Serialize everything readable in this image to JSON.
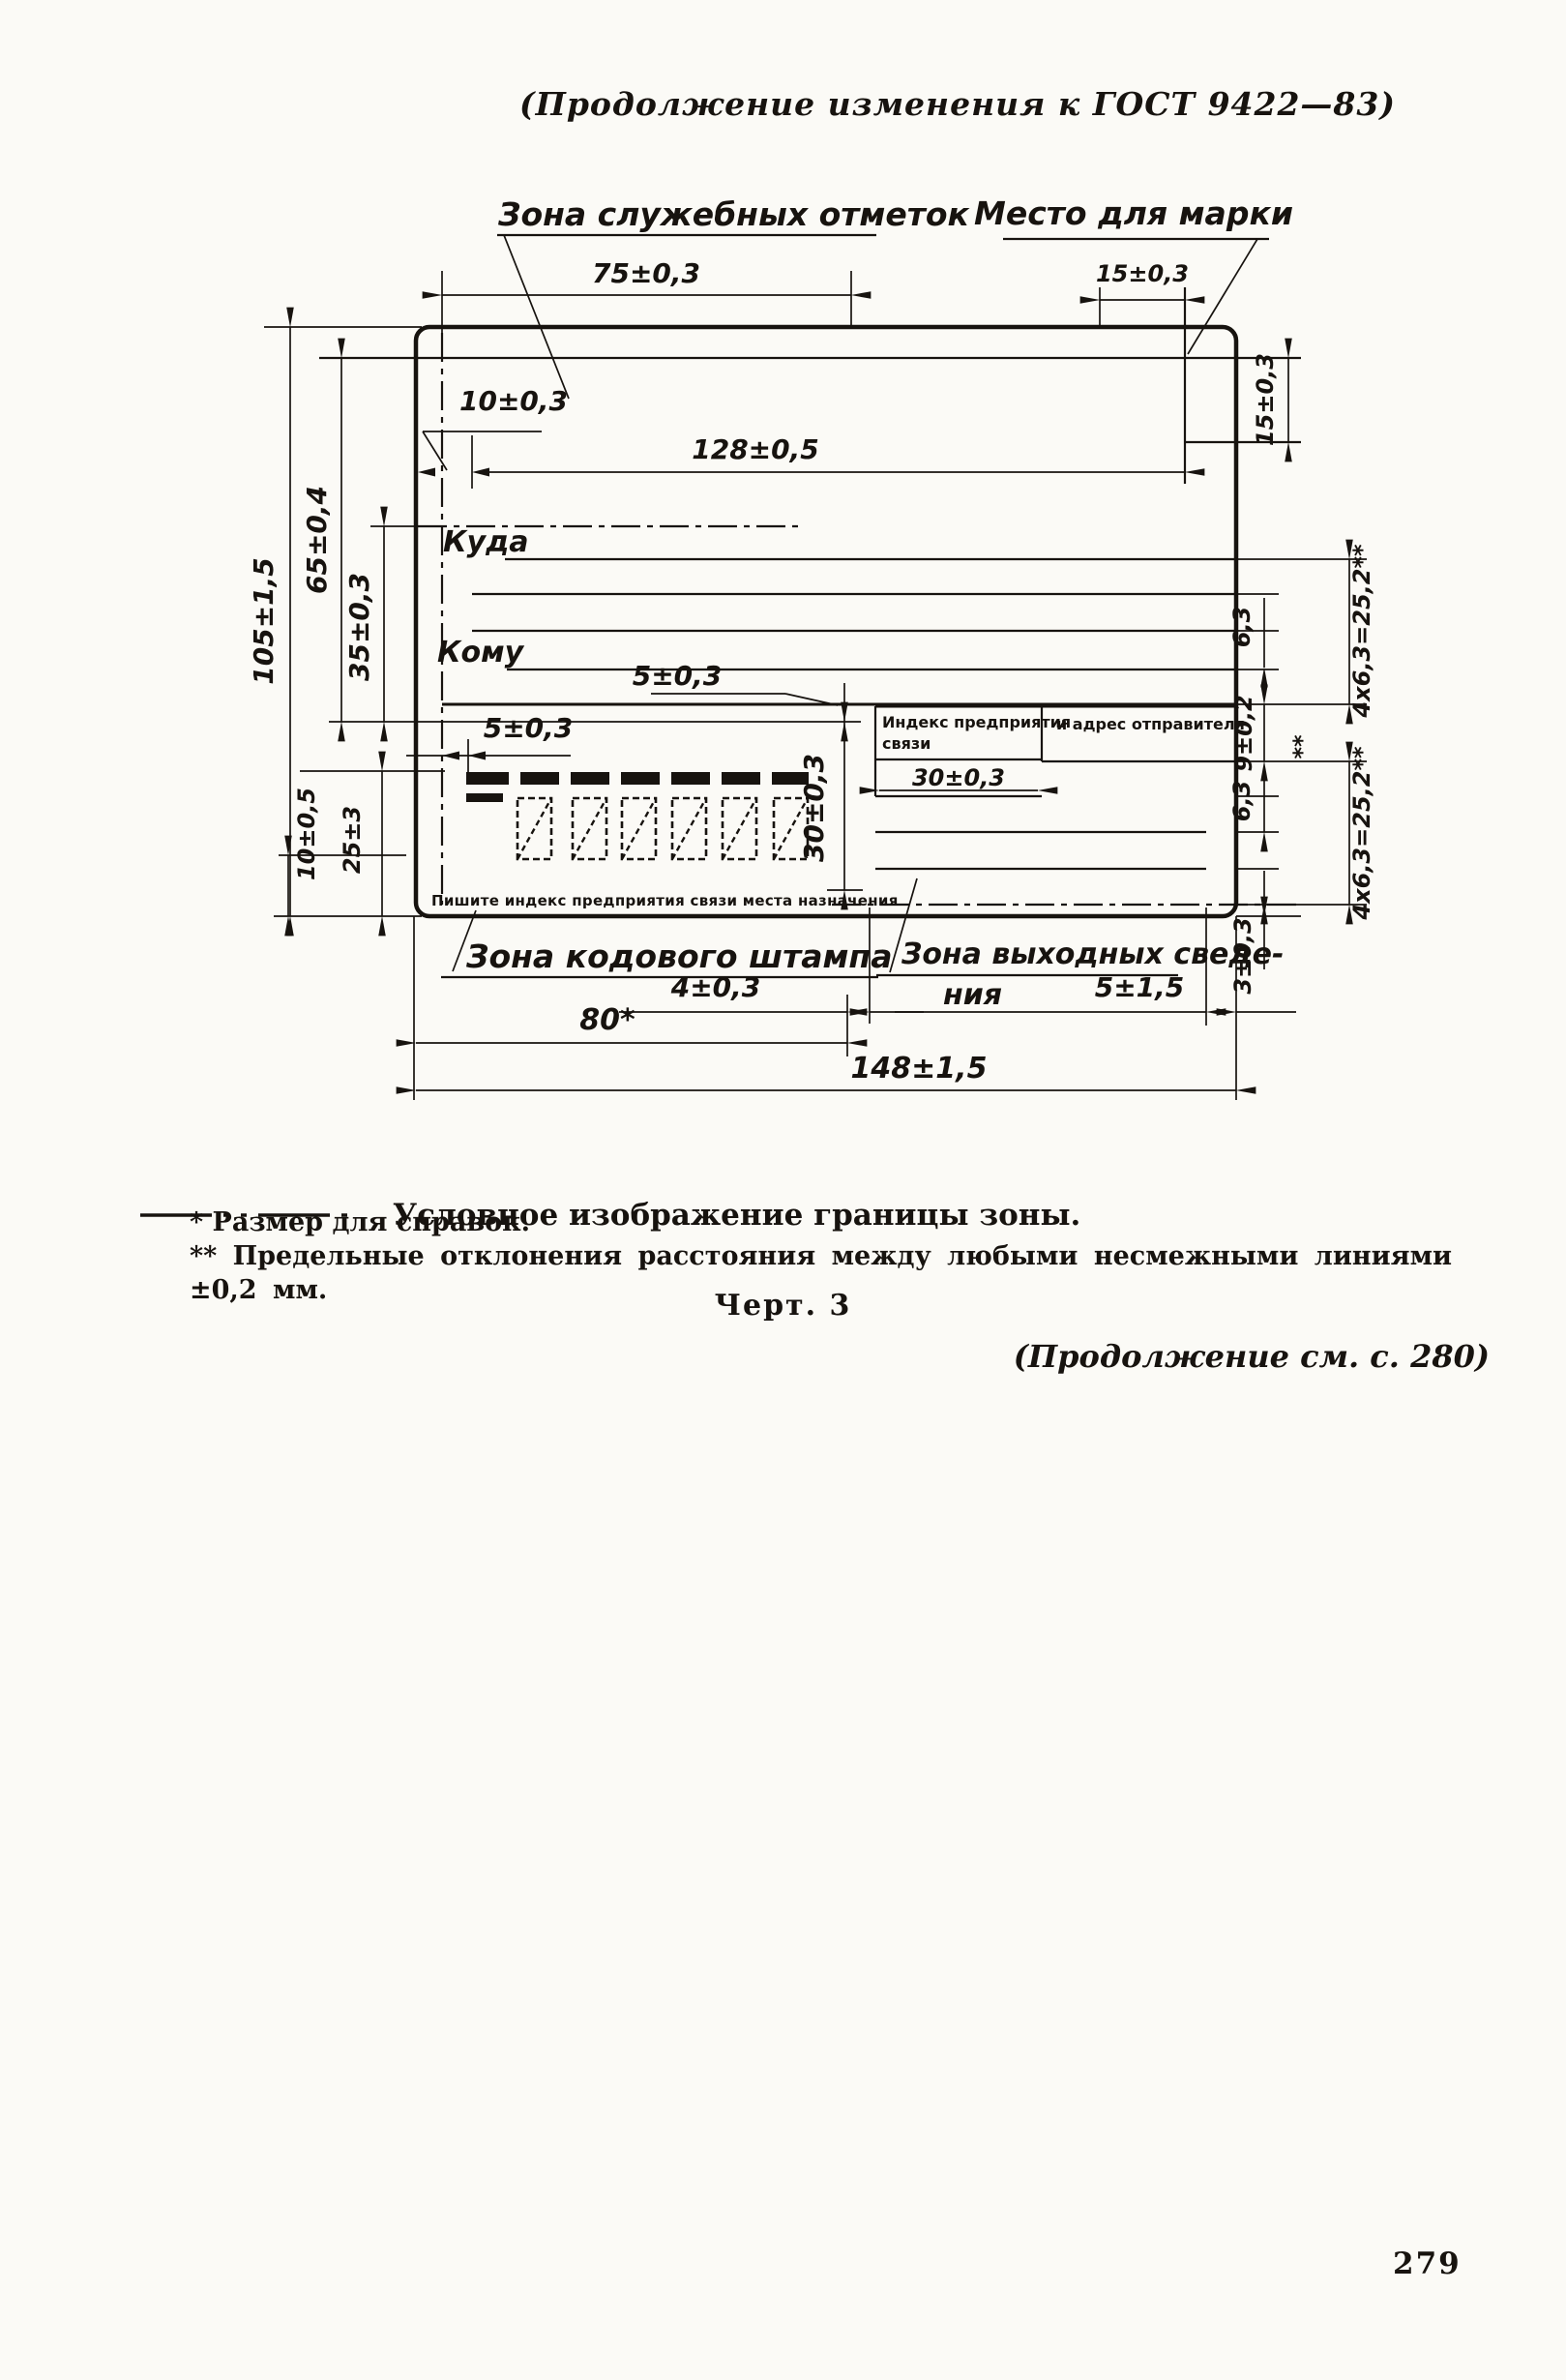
{
  "page": {
    "header": "(Продолжение изменения к ГОСТ 9422—83)",
    "figure_caption": "Черт. 3",
    "continuation_note": "(Продолжение см. с. 280)",
    "page_number": "279"
  },
  "legend": {
    "text": "Условное изображение границы зоны."
  },
  "footnotes": [
    "* Размер для справок.",
    "** Предельные отклонения расстояния между любыми несмежными линиями ±0,2 мм."
  ],
  "diagram": {
    "labels": {
      "service_zone": "Зона служебных отметок",
      "stamp_place": "Место для марки",
      "kuda": "Куда",
      "komu": "Кому",
      "index_box_left_1": "Индекс предприятия",
      "index_box_left_2": "связи",
      "index_box_right": "и адрес отправителя",
      "write_index_note": "Пишите индекс предприятия связи места назначения",
      "code_stamp_zone": "Зона кодового штампа",
      "output_info_zone_1": "Зона выходных сведе-",
      "output_info_zone_2": "ния"
    },
    "dimensions": {
      "d75": "75±0,3",
      "d15_top": "15±0,3",
      "d15_right": "15±0,3",
      "d105": "105±1,5",
      "d65": "65±0,4",
      "d35": "35±0,3",
      "d10_top": "10±0,3",
      "d128": "128±0,5",
      "d5_vert": "5±0,3",
      "d5_left": "5±0,3",
      "d30_box": "30±0,3",
      "d30_index": "30±0,3",
      "d10_bottom": "10±0,5",
      "d25": "25±3",
      "d63_upper": "6,3",
      "d463_upper": "4x6,3=25,2**",
      "d9": "9±0,2",
      "d9_stars": "**",
      "d63_lower": "6,3",
      "d463_lower": "4x6,3=25,2**",
      "d3": "3±0,3",
      "d4": "4±0,3",
      "d80": "80*",
      "d5_out": "5±1,5",
      "d148": "148±1,5"
    }
  }
}
